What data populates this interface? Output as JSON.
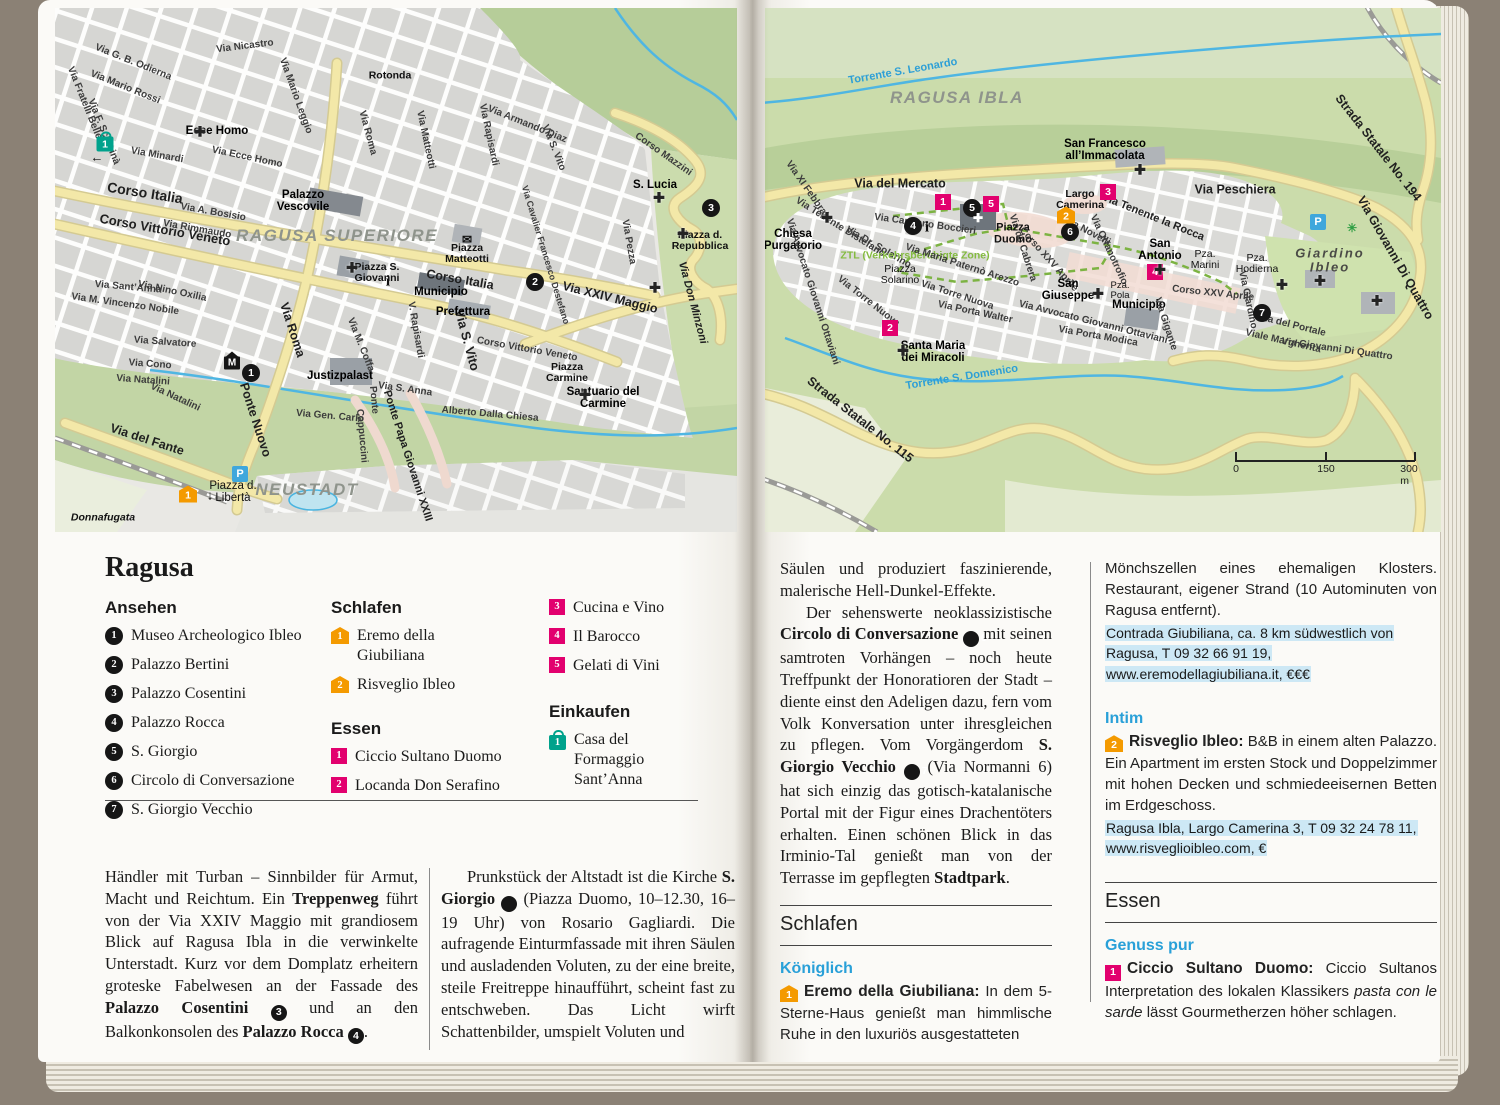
{
  "icons": {
    "church": "✚",
    "mail": "✉",
    "parking": "P",
    "museum": "M",
    "info": "i",
    "arrow_left": "←",
    "arrow_down": "↓",
    "palm": "✳"
  },
  "left_page": {
    "map": {
      "labels": {
        "nicastro": "Via Nicastro",
        "odierna": "Via G. B. Odierna",
        "mario_rossi": "Via Mario Rossi",
        "fratelli": "Via Fratelli Belleo",
        "schinina": "Via F. Schininà",
        "minardi": "Via Minardi",
        "ecce_homo_st": "Via Ecce Homo",
        "mario_leggio": "Via Mario Leggio",
        "roma_top": "Via Roma",
        "rotonda": "Rotonda",
        "corso_italia": "Corso Italia",
        "cvv": "Corso Vittorio Veneto",
        "bosisio": "Via A. Bosisio",
        "rimmaudo": "Via Rimmaudo",
        "matteotti_st": "Via Matteotti",
        "rapisardi_top": "Via Rapisardi",
        "svito_top": "Via S. Vito",
        "diaz": "Via Armando Diaz",
        "mazzini": "Corso Mazzini",
        "pezza": "Via Pezza",
        "xxiv": "Via XXIV Maggio",
        "minzoni": "Via Don Minzoni",
        "destefano": "Via Cavalier Francesco Destefano",
        "corso_italia2": "Corso Italia",
        "cvv2": "Corso Vittorio Veneto",
        "coffa": "Via M. Coffa",
        "rapisardi2": "V. Rapisardi",
        "svito": "Via S. Vito",
        "sanna": "Via S. Anna",
        "gen_carlo": "Via Gen. Carlo",
        "dalla_chiesa": "Alberto Dalla Chiesa",
        "santanna": "Via Sant’Anna",
        "oxilia": "Via Nino Oxilia",
        "nobile": "Via M. Vincenzo Nobile",
        "salvatore": "Via Salvatore",
        "cono": "Via Cono",
        "natalini": "Via Natalini",
        "natalini2": "Via Natalini",
        "roma": "Via Roma",
        "ponte_nuovo": "Ponte Nuovo",
        "ponte": "Ponte",
        "cappuccini": "Cappuccini",
        "ponte_papa": "Ponte Papa Giovanni XXIII",
        "fante": "Via del Fante",
        "ecce_homo": "Ecce Homo",
        "vescovile": "Palazzo Vescovile",
        "region": "RAGUSA SUPERIORE",
        "p_matteotti": "Piazza Matteotti",
        "p_sgiovanni": "Piazza S. Giovanni",
        "municipio": "Municipio",
        "prefettura": "Prefettura",
        "slucia": "S. Lucia",
        "p_repubblica": "Piazza d. Repubblica",
        "p_carmine": "Piazza Carmine",
        "carmine": "Santuario del Carmine",
        "justiz": "Justizpalast",
        "p_liberta": "Piazza d. Libertà",
        "neustadt": "NEUSTADT",
        "donnafugata": "Donnafugata"
      },
      "markers": {
        "shop1": "1",
        "sight1": "1",
        "sight2": "2",
        "sight3": "3",
        "hotel1": "1"
      }
    },
    "title": "Ragusa",
    "legend": {
      "ansehen": {
        "heading": "Ansehen",
        "items": [
          {
            "n": "1",
            "label": "Museo Archeologico Ibleo"
          },
          {
            "n": "2",
            "label": "Palazzo Bertini"
          },
          {
            "n": "3",
            "label": "Palazzo Cosentini"
          },
          {
            "n": "4",
            "label": "Palazzo Rocca"
          },
          {
            "n": "5",
            "label": "S. Giorgio"
          },
          {
            "n": "6",
            "label": "Circolo di Conversazione"
          },
          {
            "n": "7",
            "label": "S. Giorgio Vecchio"
          }
        ]
      },
      "schlafen": {
        "heading": "Schlafen",
        "items": [
          {
            "n": "1",
            "label": "Eremo della Giubiliana"
          },
          {
            "n": "2",
            "label": "Risveglio Ibleo"
          }
        ]
      },
      "essen": {
        "heading": "Essen",
        "items": [
          {
            "n": "1",
            "label": "Ciccio Sultano Duomo"
          },
          {
            "n": "2",
            "label": "Locanda Don Serafino"
          },
          {
            "n": "3",
            "label": "Cucina e Vino"
          },
          {
            "n": "4",
            "label": "Il Barocco"
          },
          {
            "n": "5",
            "label": "Gelati di Vini"
          }
        ]
      },
      "einkaufen": {
        "heading": "Einkaufen",
        "items": [
          {
            "n": "1",
            "label": "Casa del Formaggio Sant’Anna"
          }
        ]
      }
    },
    "article": {
      "col1": {
        "s1": "Händler mit Turban – Sinnbilder für Armut, Macht und Reichtum. Ein ",
        "b1": "Treppenweg",
        "s2": " führt von der Via XXIV Maggio mit grandiosem Blick auf Ragusa Ibla in die verwinkelte Unterstadt. Kurz vor dem Domplatz erheitern groteske Fabelwesen an der Fassade des ",
        "b2": "Palazzo Cosentini",
        "n1": "3",
        "s3": " und an den Balkonkonsolen des ",
        "b3": "Palazzo Rocca",
        "n2": "4",
        "s4": "."
      },
      "col2": {
        "s1": "Prunkstück der Altstadt ist die Kirche ",
        "b1": "S. Giorgio",
        "n1": "5",
        "s2": " (Piazza Duomo, 10–12.30, 16–19 Uhr) von Rosario Gagliardi. Die aufragende Einturmfassade mit ihren Säulen und ausladenden Voluten, zu der eine breite, steile Freitreppe hinaufführt, scheint fast zu entschweben. Das Licht wirft Schattenbilder, umspielt Voluten und"
      }
    }
  },
  "right_page": {
    "map": {
      "labels": {
        "leonardo": "Torrente S. Leonardo",
        "region": "RAGUSA IBLA",
        "sfrancesco": "San Francesco all’Immacolata",
        "ss194": "Strada Statale No. 194",
        "gdq": "Via Giovanni Di Quattro",
        "mercato": "Via del Mercato",
        "peschiera": "Via Peschiera",
        "camerina": "Largo Camerina",
        "purgatorio": "Chiesa Purgatorio",
        "febbraio": "Via XI Febbraio",
        "distefano": "Via Tenente Distefano",
        "boccieri": "Via Capitano Boccieri",
        "solarino_st": "Via Dr. Solarino",
        "ztl": "ZTL (Verkehrsberuhigte Zone)",
        "p_solarino": "Piazza Solarino",
        "arezzo": "Via Maria Paternò Arezzo",
        "torre1": "Via Torre Nuova",
        "torre2": "Via Torre Nuova",
        "walter": "Via Porta Walter",
        "ottaviani": "Via Avvocato Giovanni Ottaviani",
        "ottaviani2": "Via Avvocato Giovanni Ottaviani",
        "smiracoli": "Santa Maria dei Miracoli",
        "domenico": "Torrente S. Domenico",
        "ss115": "Strada Statale No. 115",
        "cabrera": "Via de Cabrera",
        "p_duomo": "Piazza Duomo",
        "novelli": "Via Novelli",
        "orfanotrofio": "Via Orfanotrofio",
        "larocca": "Via Tenente la Rocca",
        "santonio": "San Antonio",
        "xxv": "Corso XXV Aprile",
        "xxv2": "Corso XXV Aprile",
        "marini": "Pza. Marini",
        "pola": "Pza. Pola",
        "giuseppe": "San Giuseppe",
        "municipio": "Municipio",
        "gigante": "Via Gigante",
        "modica": "Via Porta Modica",
        "giardino_st": "Via Giardino",
        "hodierna": "Pza. Hodierna",
        "giardino": "Giardino Ibleo",
        "portale": "Via del Portale",
        "margherita": "Viale Margherita",
        "gdq2": "Via Giovanni Di Quattro"
      },
      "markers": {
        "eat1": "1",
        "eat2": "2",
        "eat3": "3",
        "eat4": "4",
        "eat5": "5",
        "hotel2": "2",
        "sight4": "4",
        "sight5": "5",
        "sight6": "6",
        "sight7": "7"
      },
      "scale": {
        "t0": "0",
        "t150": "150",
        "t300": "300 m"
      }
    },
    "article": {
      "p1": "Säulen und produziert faszinierende, malerische Hell-Dunkel-Effekte.",
      "p2": {
        "s1": "Der sehenswerte neoklassizistische ",
        "b1": "Circolo di Conversazione",
        "n1": "6",
        "s2": " mit seinen samtroten Vorhängen – noch heute Treffpunkt der Honoratioren der Stadt – diente einst den Adeligen dazu, fern vom Volk Konversation unter ihresgleichen zu pflegen. Vom Vorgängerdom ",
        "b2": "S. Giorgio Vecchio",
        "n2": "7",
        "s3": " (Via Normanni 6) hat sich einzig das gotisch-katalanische Portal mit der Figur eines Drachentöters erhalten. Einen schönen Blick in das Irminio-Tal genießt man von der Terrasse im gepflegten ",
        "b3": "Stadtpark",
        "s4": "."
      },
      "schlafen_header": "Schlafen",
      "essen_header": "Essen",
      "sub1": "Königlich",
      "e1": {
        "n": "1",
        "name": "Eremo della Giubiliana:",
        "text": " In dem 5-Sterne-Haus genießt man himmlische Ruhe in den luxuriös ausgestatteten"
      },
      "cont": "Mönchszellen eines ehemaligen Klosters. Restaurant, eigener Strand (10 Autominuten von Ragusa entfernt).",
      "contact1": "Contrada Giubiliana, ca. 8 km südwestlich von Ragusa, T 09 32 66 91 19, www.eremodellagiubiliana.it, €€€",
      "sub2": "Intim",
      "e2": {
        "n": "2",
        "name": "Risveglio Ibleo:",
        "text": " B&B in einem alten Palazzo. Ein Apartment im ersten Stock und Doppelzimmer mit hohen Decken und schmiedeeisernen Betten im Erdgeschoss."
      },
      "contact2": "Ragusa Ibla, Largo Camerina 3, T 09 32 24 78 11, www.risveglioibleo.com, €",
      "sub3": "Genuss pur",
      "e3": {
        "n": "1",
        "name": "Ciccio Sultano Duomo:",
        "t1": " Ciccio Sultanos Interpretation des lokalen Klassikers ",
        "i": "pasta con le sarde",
        "t2": " lässt Gourmetherzen höher schlagen."
      }
    }
  }
}
